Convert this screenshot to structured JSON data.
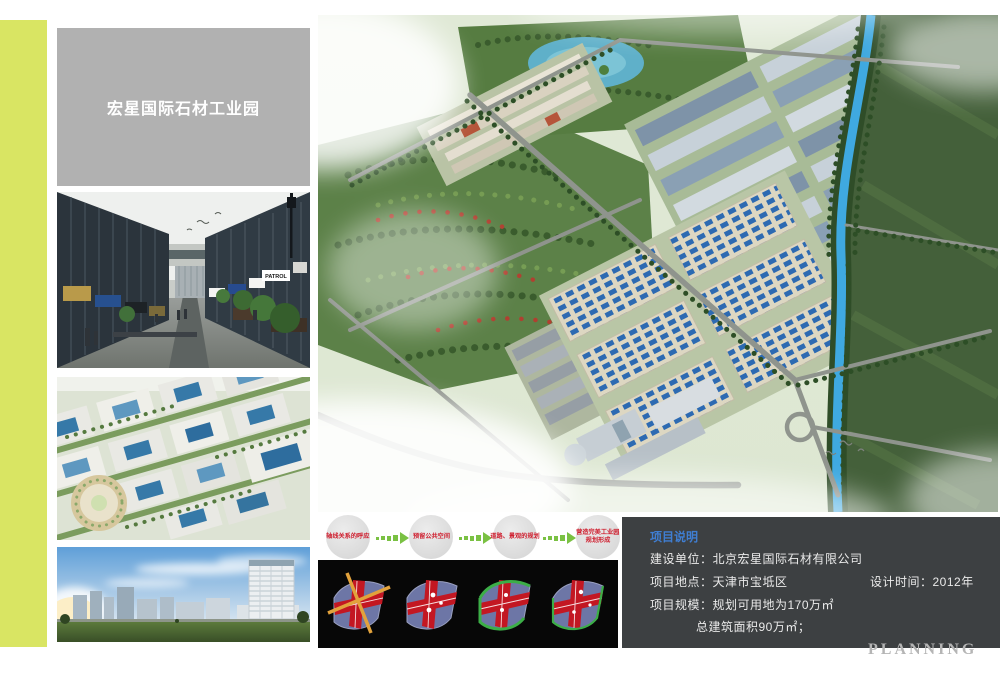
{
  "page": {
    "title": "宏星国际石材工业园",
    "watermark": "PLANNING"
  },
  "photos": {
    "street_sign_label": "PATROL"
  },
  "flow": {
    "steps": [
      {
        "line1": "轴线关系的呼应",
        "line2": ""
      },
      {
        "line1": "预留公共空间",
        "line2": ""
      },
      {
        "line1": "道路、景观的规划",
        "line2": ""
      },
      {
        "line1": "营造完美工业园",
        "line2": "规划形成"
      }
    ]
  },
  "project_info": {
    "title": "项目说明",
    "client": "建设单位：北京宏星国际石材有限公司",
    "location": "项目地点：天津市宝坻区",
    "design_time": "设计时间：2012年",
    "scale_line1": "项目规模：规划可用地为170万㎡",
    "scale_line2": "总建筑面积90万㎡；"
  },
  "colors": {
    "accent_stripe": "#d9e563",
    "info_title": "#3f7ed2",
    "flow_text": "#cf2030",
    "flow_arrow": "#7ac143",
    "info_box_bg": "#3d4042"
  }
}
